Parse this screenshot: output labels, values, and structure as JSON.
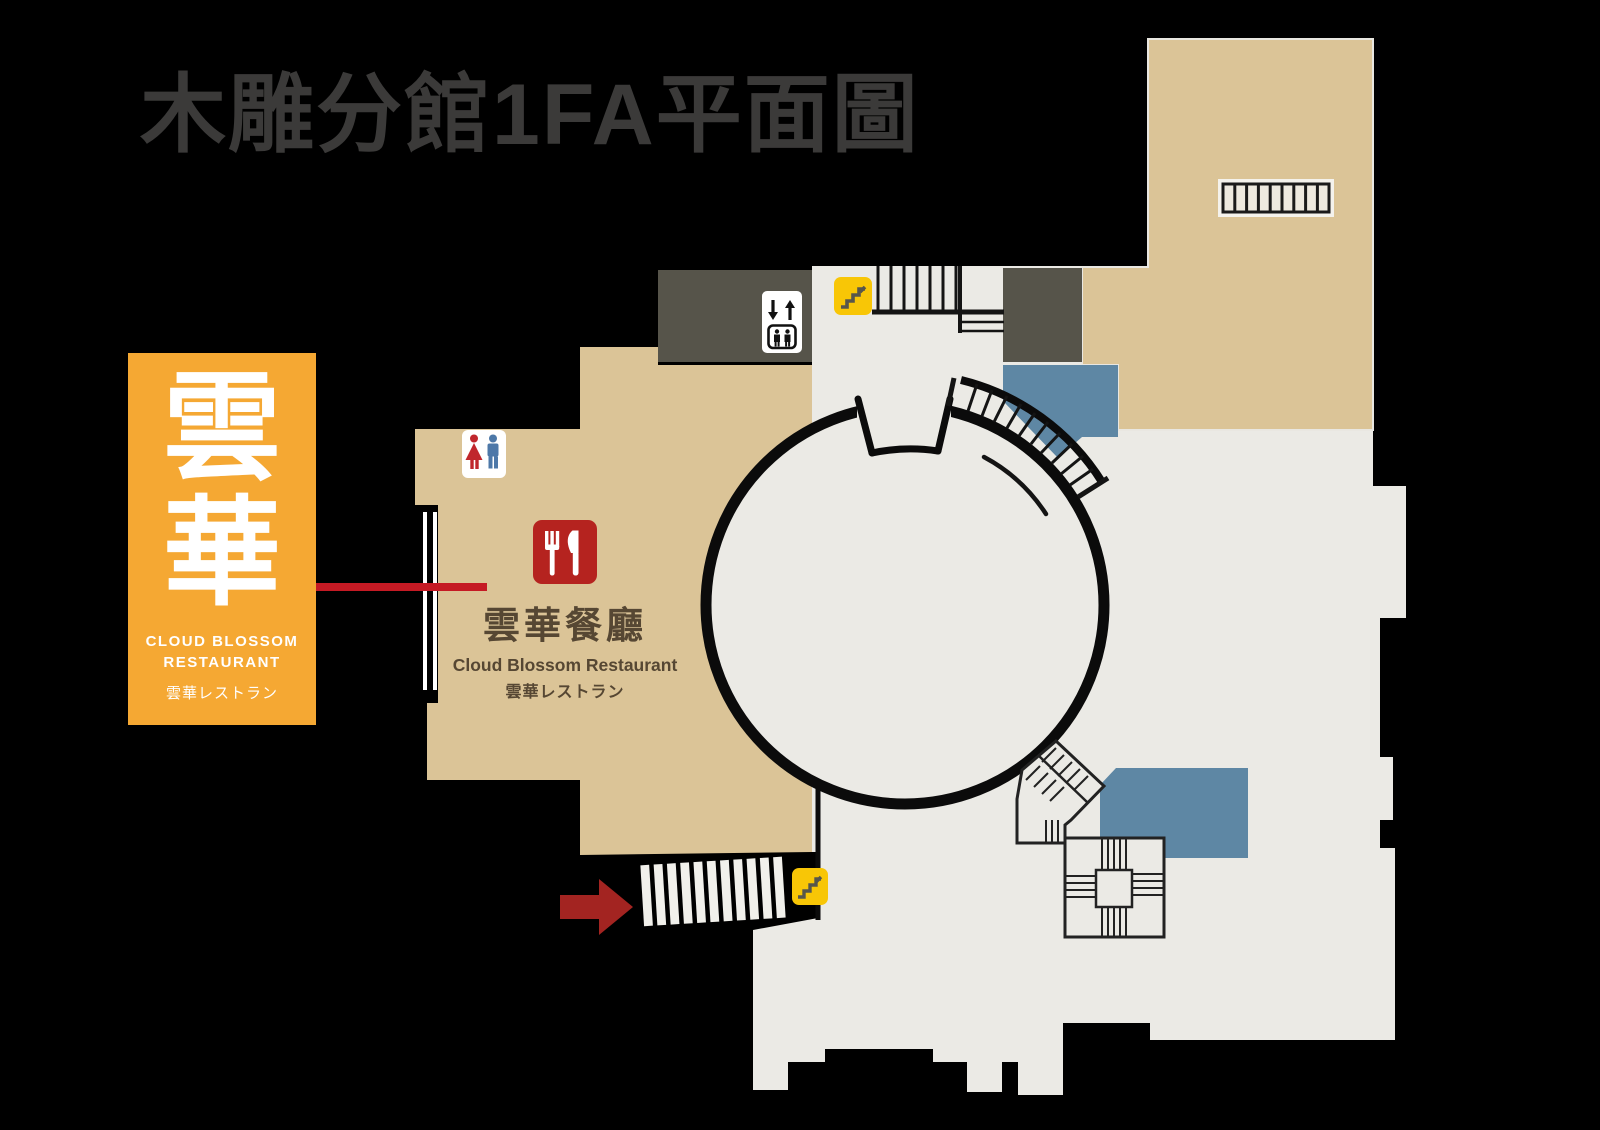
{
  "title": "木雕分館1FA平面圖",
  "legend_card": {
    "calligraphy": [
      "雲",
      "華"
    ],
    "name_en_line1": "CLOUD BLOSSOM",
    "name_en_line2": "RESTAURANT",
    "name_ja": "雲華レストラン"
  },
  "restaurant_label": {
    "zh": "雲華餐廳",
    "en": "Cloud Blossom Restaurant",
    "ja": "雲華レストラン"
  },
  "icons": {
    "restaurant": "fork-knife-icon",
    "restroom": "male-female-restroom-icon",
    "elevator": "elevator-icon",
    "escalator_upper": "stairs-icon",
    "escalator_lower": "stairs-icon",
    "entrance_arrow": "entrance-arrow"
  },
  "colors": {
    "background": "#000000",
    "title_text": "#3B3A39",
    "floor": "#EBEAE5",
    "tread": "#F1F0EB",
    "room_tan": "#DBC497",
    "service_block": "#56544A",
    "staff_area_blue": "#5E87A4",
    "legend_orange": "#F5A833",
    "callout_red": "#C51A24",
    "arrow_red": "#A32421",
    "restaurant_icon_red": "#B5231F",
    "escalator_yellow": "#F8C606",
    "label_brown": "#564733",
    "wall_black": "#0B0B0B",
    "white": "#FFFFFF",
    "female_red": "#C0272D",
    "male_blue": "#4D78A8",
    "locker_frame": "#F4F2EC"
  }
}
